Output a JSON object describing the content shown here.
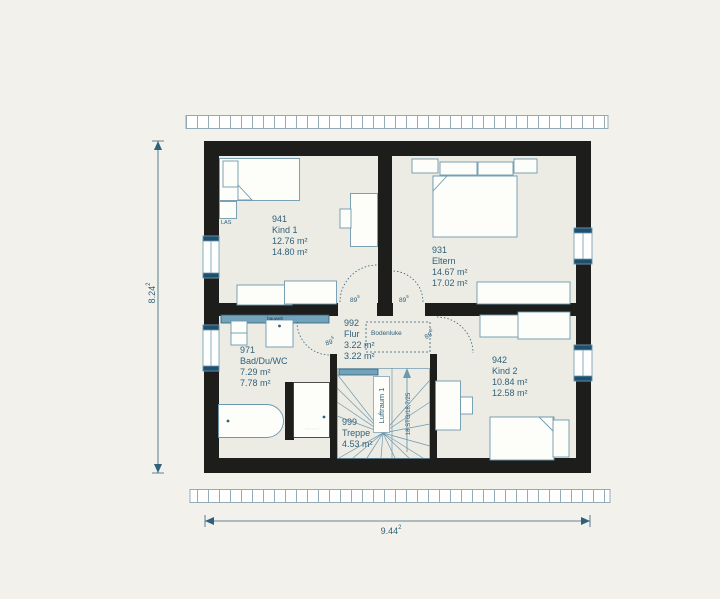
{
  "plan": {
    "rooms": [
      {
        "id": "941",
        "name": "Kind 1",
        "area1": "12.76 m²",
        "area2": "14.80 m²"
      },
      {
        "id": "931",
        "name": "Eltern",
        "area1": "14.67 m²",
        "area2": "17.02 m²"
      },
      {
        "id": "992",
        "name": "Flur",
        "area1": "3.22 m²",
        "area2": "3.22 m²"
      },
      {
        "id": "971",
        "name": "Bad/Du/WC",
        "area1": "7.29 m²",
        "area2": "7.78 m²"
      },
      {
        "id": "942",
        "name": "Kind 2",
        "area1": "10.84 m²",
        "area2": "12.58 m²"
      },
      {
        "id": "999",
        "name": "Treppe",
        "area1": "4.53 m²"
      }
    ],
    "door_label": {
      "value": "89",
      "sup": "5"
    },
    "dims": {
      "width": {
        "value": "9.44",
        "sup": "2"
      },
      "height": {
        "value": "8.24",
        "sup": "2"
      }
    },
    "annotations": {
      "bodenluke": "Bodenluke",
      "luftraum": "Luftraum 1",
      "stair_spec": "18 STG/18,7/25",
      "furniture_tag": "LAS",
      "radiator_label": "bauwelt"
    },
    "colors": {
      "wall": "#1d1d1b",
      "floor": "#ecebe4",
      "line_blue": "#6d98ad",
      "text_blue": "#2f617a",
      "radiator": "#72a3bb",
      "window_cap": "#1d4f6e"
    }
  }
}
